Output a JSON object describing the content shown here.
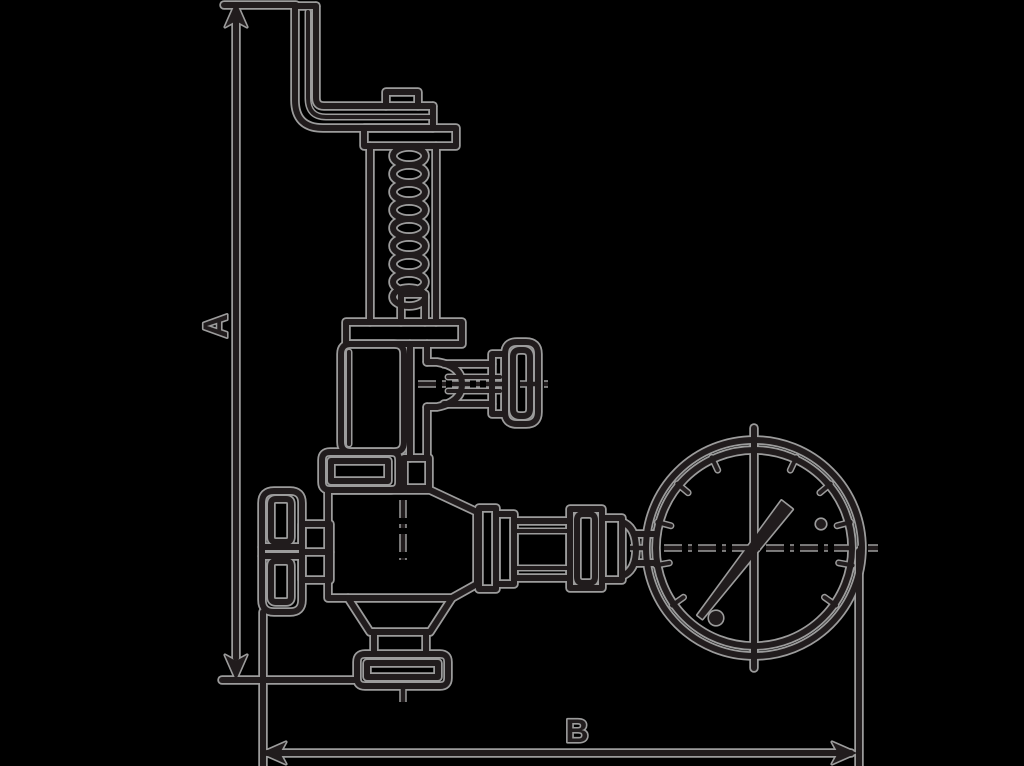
{
  "page": {
    "background": "#000000"
  },
  "drawing": {
    "type": "technical-line-drawing",
    "subject": "safety relief valve with lever, handwheel and pressure gauge, with overall dimension callouts",
    "ink_color": "#211c1d",
    "outline_color": "#9c9c9c",
    "dimensions": {
      "a_label": "A",
      "b_label": "B"
    },
    "parts": [
      "lever-arm",
      "coil-spring",
      "spring-housing",
      "bonnet",
      "side-knob",
      "handwheel",
      "valve-body",
      "outlet-flange",
      "pipe-fitting-train",
      "pressure-gauge",
      "gauge-needle"
    ]
  }
}
